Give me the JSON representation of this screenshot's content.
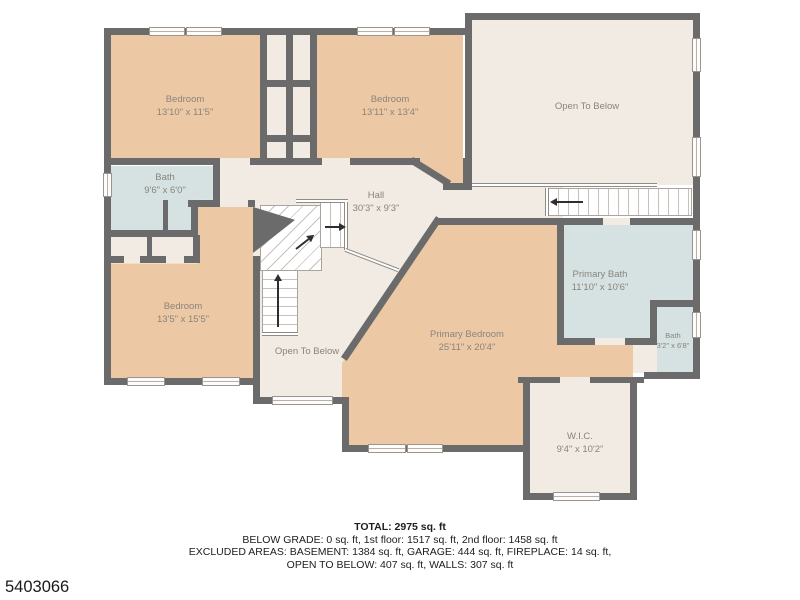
{
  "floor_plan": {
    "rooms": [
      {
        "name": "Bedroom",
        "dims": "13'10\" x 11'5\""
      },
      {
        "name": "Bedroom",
        "dims": "13'11\" x 13'4\""
      },
      {
        "name": "Open To Below",
        "dims": ""
      },
      {
        "name": "Bath",
        "dims": "9'6\" x 6'0\""
      },
      {
        "name": "Hall",
        "dims": "30'3\" x 9'3\""
      },
      {
        "name": "Bedroom",
        "dims": "13'5\" x 15'5\""
      },
      {
        "name": "Open To Below",
        "dims": ""
      },
      {
        "name": "Primary Bedroom",
        "dims": "25'11\" x 20'4\""
      },
      {
        "name": "Primary Bath",
        "dims": "11'10\" x 10'6\""
      },
      {
        "name": "Bath",
        "dims": "3'2\" x 6'8\""
      },
      {
        "name": "W.I.C.",
        "dims": "9'4\" x 10'2\""
      }
    ],
    "colors": {
      "wall": "#6b6b6b",
      "room_fill": "#ecc9a4",
      "open_area_fill": "#f2ebe4",
      "bath_fill": "#d5e2e1",
      "label_text": "#8a847e"
    }
  },
  "footer": {
    "total": "TOTAL: 2975 sq. ft",
    "line2": "BELOW GRADE: 0 sq. ft, 1st floor: 1517 sq. ft, 2nd floor: 1458 sq. ft",
    "line3": "EXCLUDED AREAS: BASEMENT: 1384 sq. ft, GARAGE: 444 sq. ft, FIREPLACE: 14 sq. ft,",
    "line4": "OPEN TO BELOW: 407 sq. ft, WALLS: 307 sq. ft"
  },
  "photo_id": "5403066"
}
